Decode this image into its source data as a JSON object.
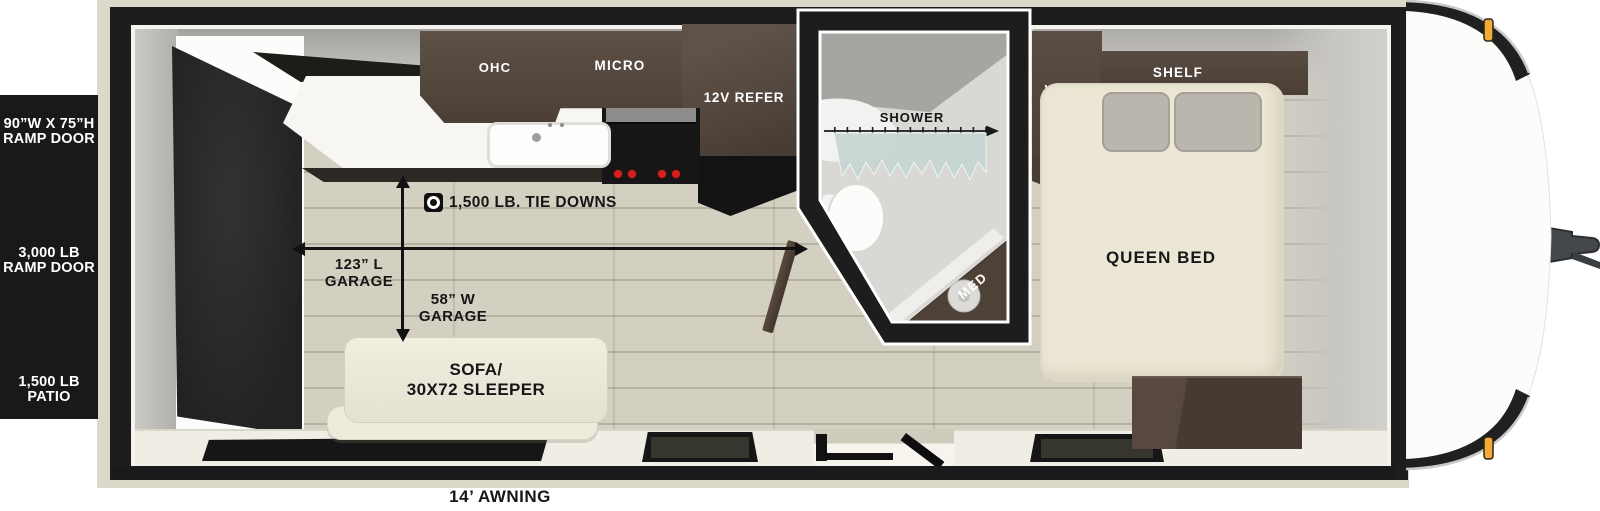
{
  "meta": {
    "type": "travel-trailer floorplan diagram"
  },
  "colors": {
    "wall_black": "#1d1d1d",
    "trim_beige": "#dcd9cb",
    "floor_plank": "#d3d0c1",
    "cabinet_brown": "#54473d",
    "counter_white": "#f7f6f3",
    "sofa_cream": "#edeadb",
    "bed_cream": "#ece7d5",
    "curtain_teal": "#c6d6d2",
    "marker_light_orange": "#f1a93a",
    "stove_knob_red": "#d61f1f"
  },
  "patio_panel": {
    "size_line1": "90”W X 75”H",
    "size_line2": "RAMP DOOR",
    "weight_line1": "3,000 LB",
    "weight_line2": "RAMP DOOR",
    "patio_line1": "1,500 LB",
    "patio_line2": "PATIO"
  },
  "kitchen": {
    "ohc": "OHC",
    "micro": "MICRO",
    "refer": "12V REFER"
  },
  "garage": {
    "tie_downs": "1,500 LB. TIE DOWNS",
    "length_line1": "123” L",
    "length_line2": "GARAGE",
    "width_line1": "58” W",
    "width_line2": "GARAGE"
  },
  "sofa": {
    "line1": "SOFA/",
    "line2": "30X72 SLEEPER"
  },
  "bathroom": {
    "shower": "SHOWER",
    "med": "MED"
  },
  "bedroom": {
    "ward": "WARD",
    "shelf": "SHELF",
    "bed": "QUEEN BED"
  },
  "exterior": {
    "awning": "14’ AWNING"
  }
}
